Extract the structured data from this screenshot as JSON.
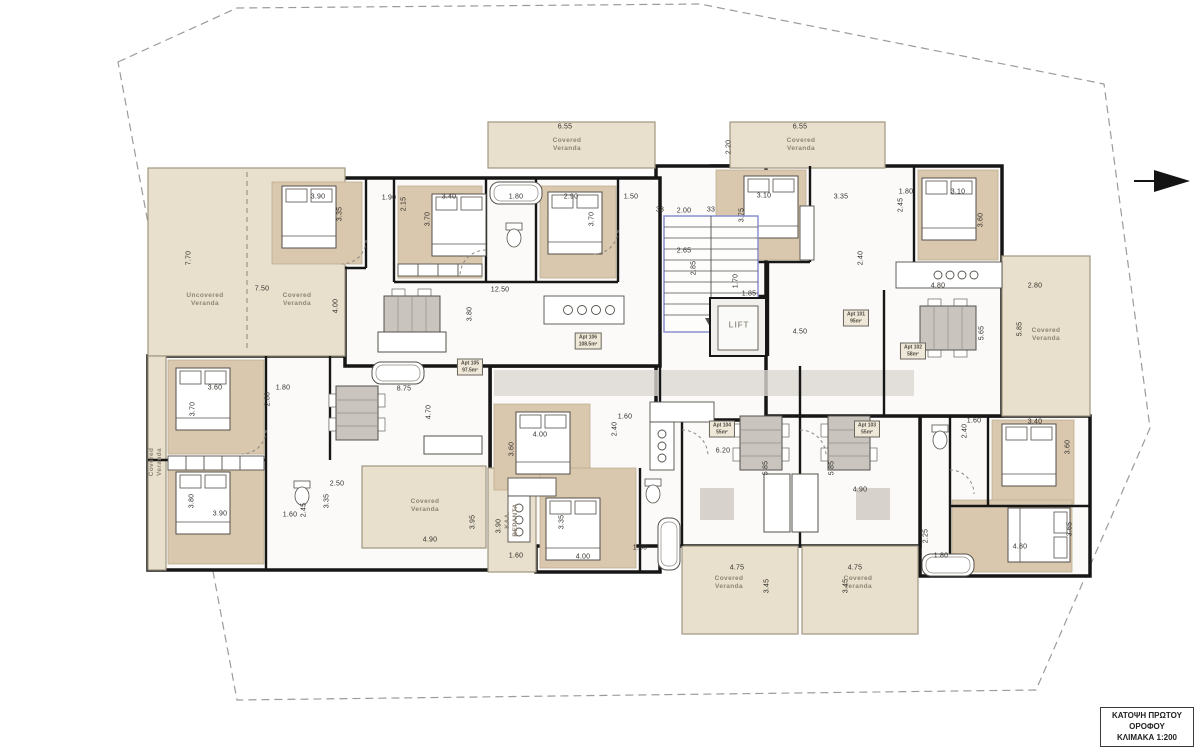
{
  "page": {
    "width": 1197,
    "height": 748,
    "background": "#ffffff"
  },
  "title_block": {
    "lines": [
      "ΚΑΤΟΨΗ ΠΡΩΤΟΥ",
      "ΟΡΟΦΟΥ",
      "ΚΛΙΜΑΚΑ 1:200"
    ]
  },
  "lift": {
    "label": "LIFT",
    "x": 739,
    "y": 325
  },
  "icons": {
    "north_arrow": "east-pointing-triangle"
  },
  "colors": {
    "wall": "#161616",
    "veranda_fill": "#e8e0cc",
    "veranda_edge": "#a09780",
    "wood_floor": "#d9c7ae",
    "interior": "#fbfaf8",
    "stair_accent": "#8a90cf",
    "boundary": "#9b9b9b",
    "dim_text": "#33302c",
    "label_gray": "#8d8476"
  },
  "apartments": [
    {
      "label": "Apt 105",
      "area": "97.5m²",
      "x": 470,
      "y": 367
    },
    {
      "label": "Apt 106",
      "area": "108.5m²",
      "x": 588,
      "y": 341
    },
    {
      "label": "Apt 101",
      "area": "95m²",
      "x": 856,
      "y": 318
    },
    {
      "label": "Apt 102",
      "area": "58m²",
      "x": 913,
      "y": 351
    },
    {
      "label": "Apt 104",
      "area": "55m²",
      "x": 722,
      "y": 429
    },
    {
      "label": "Apt 103",
      "area": "55m²",
      "x": 867,
      "y": 429
    }
  ],
  "veranda_labels": [
    {
      "lines": [
        "Covered",
        "Veranda"
      ],
      "x": 567,
      "y": 145,
      "r": 0
    },
    {
      "lines": [
        "Covered",
        "Veranda"
      ],
      "x": 801,
      "y": 145,
      "r": 0
    },
    {
      "lines": [
        "Uncovered",
        "Veranda"
      ],
      "x": 205,
      "y": 300,
      "r": 0
    },
    {
      "lines": [
        "Covered",
        "Veranda"
      ],
      "x": 297,
      "y": 300,
      "r": 0
    },
    {
      "lines": [
        "Covered",
        "Veranda"
      ],
      "x": 1046,
      "y": 335,
      "r": 0
    },
    {
      "lines": [
        "Covered",
        "Veranda"
      ],
      "x": 156,
      "y": 462,
      "r": -90
    },
    {
      "lines": [
        "Covered",
        "Veranda"
      ],
      "x": 425,
      "y": 506,
      "r": 0
    },
    {
      "lines": [
        "ΚΑΛ.",
        "ΒΕΡΑΝΤΑ"
      ],
      "x": 512,
      "y": 520,
      "r": -90
    },
    {
      "lines": [
        "Covered",
        "Veranda"
      ],
      "x": 729,
      "y": 583,
      "r": 0
    },
    {
      "lines": [
        "Covered",
        "Veranda"
      ],
      "x": 858,
      "y": 583,
      "r": 0
    }
  ],
  "dimensions": [
    {
      "t": "6.55",
      "x": 565,
      "y": 127,
      "r": 0
    },
    {
      "t": "6.55",
      "x": 800,
      "y": 127,
      "r": 0
    },
    {
      "t": "33",
      "x": 660,
      "y": 210,
      "r": 0
    },
    {
      "t": "2.00",
      "x": 684,
      "y": 211,
      "r": 0
    },
    {
      "t": "33",
      "x": 711,
      "y": 210,
      "r": 0
    },
    {
      "t": "2.65",
      "x": 684,
      "y": 251,
      "r": 0
    },
    {
      "t": "2.85",
      "x": 694,
      "y": 268,
      "r": -90
    },
    {
      "t": "3.90",
      "x": 318,
      "y": 197,
      "r": 0
    },
    {
      "t": "3.35",
      "x": 340,
      "y": 214,
      "r": -90
    },
    {
      "t": "1.90",
      "x": 389,
      "y": 198,
      "r": 0
    },
    {
      "t": "2.15",
      "x": 404,
      "y": 204,
      "r": -90
    },
    {
      "t": "3.40",
      "x": 449,
      "y": 197,
      "r": 0
    },
    {
      "t": "3.70",
      "x": 428,
      "y": 219,
      "r": -90
    },
    {
      "t": "1.80",
      "x": 516,
      "y": 197,
      "r": 0
    },
    {
      "t": "2.90",
      "x": 571,
      "y": 197,
      "r": 0
    },
    {
      "t": "3.70",
      "x": 592,
      "y": 219,
      "r": -90
    },
    {
      "t": "1.50",
      "x": 631,
      "y": 197,
      "r": 0
    },
    {
      "t": "7.70",
      "x": 189,
      "y": 258,
      "r": -90
    },
    {
      "t": "7.50",
      "x": 262,
      "y": 289,
      "r": 0
    },
    {
      "t": "4.00",
      "x": 336,
      "y": 306,
      "r": -90
    },
    {
      "t": "12.50",
      "x": 500,
      "y": 290,
      "r": 0
    },
    {
      "t": "3.80",
      "x": 470,
      "y": 314,
      "r": -90
    },
    {
      "t": "8.75",
      "x": 404,
      "y": 389,
      "r": 0
    },
    {
      "t": "4.70",
      "x": 429,
      "y": 412,
      "r": -90
    },
    {
      "t": "1.70",
      "x": 736,
      "y": 281,
      "r": -90
    },
    {
      "t": "1.85",
      "x": 749,
      "y": 294,
      "r": 0
    },
    {
      "t": "4.50",
      "x": 800,
      "y": 332,
      "r": 0
    },
    {
      "t": "2.20",
      "x": 729,
      "y": 147,
      "r": -90
    },
    {
      "t": "3.10",
      "x": 764,
      "y": 196,
      "r": 0
    },
    {
      "t": "3.75",
      "x": 742,
      "y": 215,
      "r": -90
    },
    {
      "t": "3.35",
      "x": 841,
      "y": 197,
      "r": 0
    },
    {
      "t": "1.80",
      "x": 906,
      "y": 192,
      "r": 0
    },
    {
      "t": "2.45",
      "x": 901,
      "y": 205,
      "r": -90
    },
    {
      "t": "3.10",
      "x": 958,
      "y": 192,
      "r": 0
    },
    {
      "t": "3.60",
      "x": 981,
      "y": 220,
      "r": -90
    },
    {
      "t": "2.40",
      "x": 861,
      "y": 258,
      "r": -90
    },
    {
      "t": "4.80",
      "x": 938,
      "y": 286,
      "r": 0
    },
    {
      "t": "2.80",
      "x": 1035,
      "y": 286,
      "r": 0
    },
    {
      "t": "5.65",
      "x": 982,
      "y": 333,
      "r": -90
    },
    {
      "t": "5.85",
      "x": 1020,
      "y": 329,
      "r": -90
    },
    {
      "t": "1.60",
      "x": 625,
      "y": 417,
      "r": 0
    },
    {
      "t": "2.40",
      "x": 615,
      "y": 429,
      "r": -90
    },
    {
      "t": "6.20",
      "x": 723,
      "y": 451,
      "r": 0
    },
    {
      "t": "5.85",
      "x": 766,
      "y": 468,
      "r": -90
    },
    {
      "t": "5.85",
      "x": 832,
      "y": 468,
      "r": -90
    },
    {
      "t": "4.90",
      "x": 860,
      "y": 490,
      "r": 0
    },
    {
      "t": "4.00",
      "x": 540,
      "y": 435,
      "r": 0
    },
    {
      "t": "3.60",
      "x": 512,
      "y": 449,
      "r": -90
    },
    {
      "t": "3.60",
      "x": 215,
      "y": 388,
      "r": 0
    },
    {
      "t": "3.70",
      "x": 193,
      "y": 409,
      "r": -90
    },
    {
      "t": "1.80",
      "x": 283,
      "y": 388,
      "r": 0
    },
    {
      "t": "2.80",
      "x": 268,
      "y": 399,
      "r": -90
    },
    {
      "t": "3.80",
      "x": 192,
      "y": 501,
      "r": -90
    },
    {
      "t": "3.90",
      "x": 220,
      "y": 514,
      "r": 0
    },
    {
      "t": "1.60",
      "x": 290,
      "y": 515,
      "r": 0
    },
    {
      "t": "2.45",
      "x": 304,
      "y": 510,
      "r": -90
    },
    {
      "t": "2.50",
      "x": 337,
      "y": 484,
      "r": 0
    },
    {
      "t": "3.35",
      "x": 327,
      "y": 501,
      "r": -90
    },
    {
      "t": "4.90",
      "x": 430,
      "y": 540,
      "r": 0
    },
    {
      "t": "3.95",
      "x": 473,
      "y": 522,
      "r": -90
    },
    {
      "t": "3.90",
      "x": 499,
      "y": 526,
      "r": -90
    },
    {
      "t": "1.60",
      "x": 516,
      "y": 556,
      "r": 0
    },
    {
      "t": "3.35",
      "x": 562,
      "y": 522,
      "r": -90
    },
    {
      "t": "4.00",
      "x": 583,
      "y": 557,
      "r": 0
    },
    {
      "t": "1.80",
      "x": 640,
      "y": 548,
      "r": 0
    },
    {
      "t": "4.75",
      "x": 737,
      "y": 568,
      "r": 0
    },
    {
      "t": "3.45",
      "x": 767,
      "y": 586,
      "r": -90
    },
    {
      "t": "3.45",
      "x": 846,
      "y": 586,
      "r": -90
    },
    {
      "t": "4.75",
      "x": 855,
      "y": 568,
      "r": 0
    },
    {
      "t": "1.60",
      "x": 974,
      "y": 421,
      "r": 0
    },
    {
      "t": "2.40",
      "x": 965,
      "y": 431,
      "r": -90
    },
    {
      "t": "3.40",
      "x": 1035,
      "y": 422,
      "r": 0
    },
    {
      "t": "3.60",
      "x": 1068,
      "y": 447,
      "r": -90
    },
    {
      "t": "2.25",
      "x": 926,
      "y": 536,
      "r": -90
    },
    {
      "t": "1.80",
      "x": 941,
      "y": 556,
      "r": 0
    },
    {
      "t": "4.80",
      "x": 1020,
      "y": 547,
      "r": 0
    },
    {
      "t": "3.65",
      "x": 1070,
      "y": 529,
      "r": -90
    }
  ]
}
